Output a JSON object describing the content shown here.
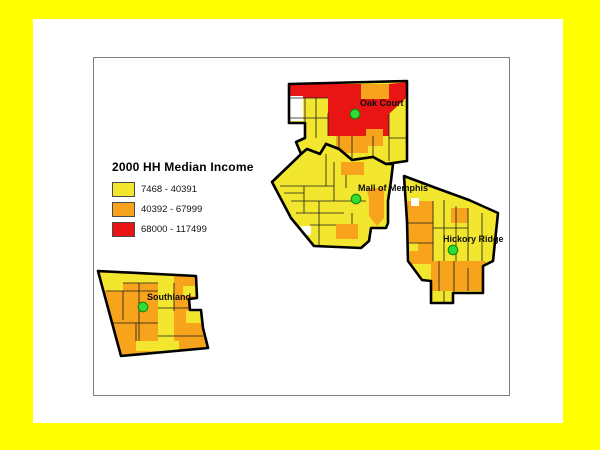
{
  "frame": {
    "border_color": "#FFFF00",
    "canvas_color": "#FFFFFF",
    "map_border_color": "#808080"
  },
  "legend": {
    "title": "2000 HH Median Income",
    "items": [
      {
        "id": "low",
        "label": "7468 - 40391",
        "color": "#F2E72E"
      },
      {
        "id": "mid",
        "label": "40392 - 67999",
        "color": "#F7A41C"
      },
      {
        "id": "high",
        "label": "68000 - 117499",
        "color": "#E91414"
      }
    ]
  },
  "map": {
    "width": 415,
    "height": 337,
    "nodata_color": "#FFFFFF",
    "outline_color": "#000000",
    "tract_line_color": "#1A1A1A",
    "marker_color": "#33DB33",
    "marker_stroke": "#0E8A0E",
    "markers": [
      {
        "id": "oak-court",
        "name": "Oak Court",
        "x": 261,
        "y": 56,
        "label_x": 266,
        "label_y": 40
      },
      {
        "id": "mall-of-memphis",
        "name": "Mall of Memphis",
        "x": 262,
        "y": 141,
        "label_x": 264,
        "label_y": 125
      },
      {
        "id": "hickory-ridge",
        "name": "Hickory Ridge",
        "x": 359,
        "y": 192,
        "label_x": 349,
        "label_y": 176
      },
      {
        "id": "southland",
        "name": "Southland",
        "x": 49,
        "y": 249,
        "label_x": 53,
        "label_y": 234
      }
    ],
    "regions": [
      {
        "id": "oak-court",
        "base": "low",
        "outline": "M195,26 L313,23 L313,103 L292,106 L279,99 L258,102 L245,91 L232,86 L226,96 L213,91 L207,96 L202,84 L211,80 L211,65 L195,65 Z",
        "fills": [
          {
            "c": "high",
            "d": "M195,26 L267,26 L267,40 L195,40 Z"
          },
          {
            "c": "high",
            "d": "M234,40 L295,40 L295,78 L234,78 Z"
          },
          {
            "c": "high",
            "d": "M295,26 L313,24 L313,39 L295,56 Z"
          },
          {
            "c": "mid",
            "d": "M267,26 L295,26 L295,41 L267,41 Z"
          },
          {
            "c": "mid",
            "d": "M242,78 L274,78 L274,95 L242,95 Z"
          },
          {
            "c": "mid",
            "d": "M272,71 L289,71 L289,88 L272,88 Z"
          },
          {
            "c": "nodata",
            "d": "M196,38 L209,38 L209,63 L196,63 Z"
          }
        ],
        "lines": [
          "M195,40 L234,40",
          "M211,40 L211,78",
          "M222,40 L222,80",
          "M196,60 L222,60",
          "M234,55 L234,78",
          "M295,56 L295,103",
          "M295,80 L313,80",
          "M258,78 L258,101",
          "M279,78 L279,99",
          "M245,78 L245,91",
          "M222,60 L234,60"
        ]
      },
      {
        "id": "mall-of-memphis",
        "base": "low",
        "outline": "M178,124 L203,100 L207,96 L213,91 L226,96 L232,86 L245,91 L258,102 L279,99 L292,106 L299,106 L297,123 L294,143 L294,165 L292,170 L277,170 L275,183 L267,190 L220,188 L197,160 Z",
        "fills": [
          {
            "c": "mid",
            "d": "M272,130 L290,130 L290,160 L283,168 L275,158 L275,140 Z"
          },
          {
            "c": "mid",
            "d": "M247,104 L270,104 L270,117 L247,117 Z"
          },
          {
            "c": "mid",
            "d": "M242,166 L264,166 L264,181 L242,181 Z"
          },
          {
            "c": "nodata",
            "d": "M207,168 L217,168 L217,177 L207,177 Z"
          }
        ],
        "lines": [
          "M186,128 L240,128",
          "M197,143 L272,143",
          "M202,155 L250,155",
          "M216,167 L242,167",
          "M210,128 L210,155",
          "M225,143 L225,188",
          "M240,104 L240,143",
          "M252,117 L252,130",
          "M232,96 L232,128",
          "M258,155 L258,166",
          "M190,135 L210,135"
        ]
      },
      {
        "id": "hickory-ridge",
        "base": "low",
        "outline": "M310,118 L342,130 L375,142 L404,155 L399,203 L389,208 L389,235 L359,235 L359,245 L337,245 L337,223 L328,222 L314,203 L313,163 Z",
        "fills": [
          {
            "c": "mid",
            "d": "M313,143 L339,143 L339,206 L316,206 Z"
          },
          {
            "c": "mid",
            "d": "M357,150 L374,150 L374,165 L357,165 Z"
          },
          {
            "c": "mid",
            "d": "M337,203 L392,203 L392,233 L337,233 Z"
          },
          {
            "c": "low",
            "d": "M315,185 L324,185 L324,193 L315,193 Z"
          },
          {
            "c": "nodata",
            "d": "M317,140 L325,140 L325,148 L317,148 Z"
          }
        ],
        "lines": [
          "M314,165 L339,165",
          "M314,185 L339,185",
          "M339,143 L339,203",
          "M350,142 L350,203",
          "M362,148 L362,203",
          "M374,150 L374,203",
          "M388,155 L388,203",
          "M339,170 L374,170",
          "M345,203 L345,233",
          "M360,203 L360,235",
          "M374,210 L374,233",
          "M350,233 L350,245"
        ]
      },
      {
        "id": "southland",
        "base": "mid",
        "outline": "M4,213 L102,218 L103,240 L95,241 L96,252 L107,252 L109,270 L114,290 L27,298 Z",
        "fills": [
          {
            "c": "low",
            "d": "M5,215 L29,215 L29,233 L5,233 Z"
          },
          {
            "c": "low",
            "d": "M29,215 L64,215 L64,225 L29,225 Z"
          },
          {
            "c": "low",
            "d": "M64,216 L80,216 L80,296 L64,296 Z"
          },
          {
            "c": "low",
            "d": "M89,228 L102,228 L102,238 L89,238 Z"
          },
          {
            "c": "low",
            "d": "M92,253 L107,253 L107,265 L92,265 Z"
          },
          {
            "c": "low",
            "d": "M42,283 L85,283 L85,293 L42,293 Z"
          }
        ],
        "lines": [
          "M29,225 L64,225",
          "M12,233 L64,233",
          "M29,233 L29,262",
          "M45,225 L45,283",
          "M64,250 L95,250",
          "M80,225 L80,253",
          "M18,265 L64,265",
          "M42,265 L42,283",
          "M64,278 L109,278"
        ]
      }
    ]
  }
}
